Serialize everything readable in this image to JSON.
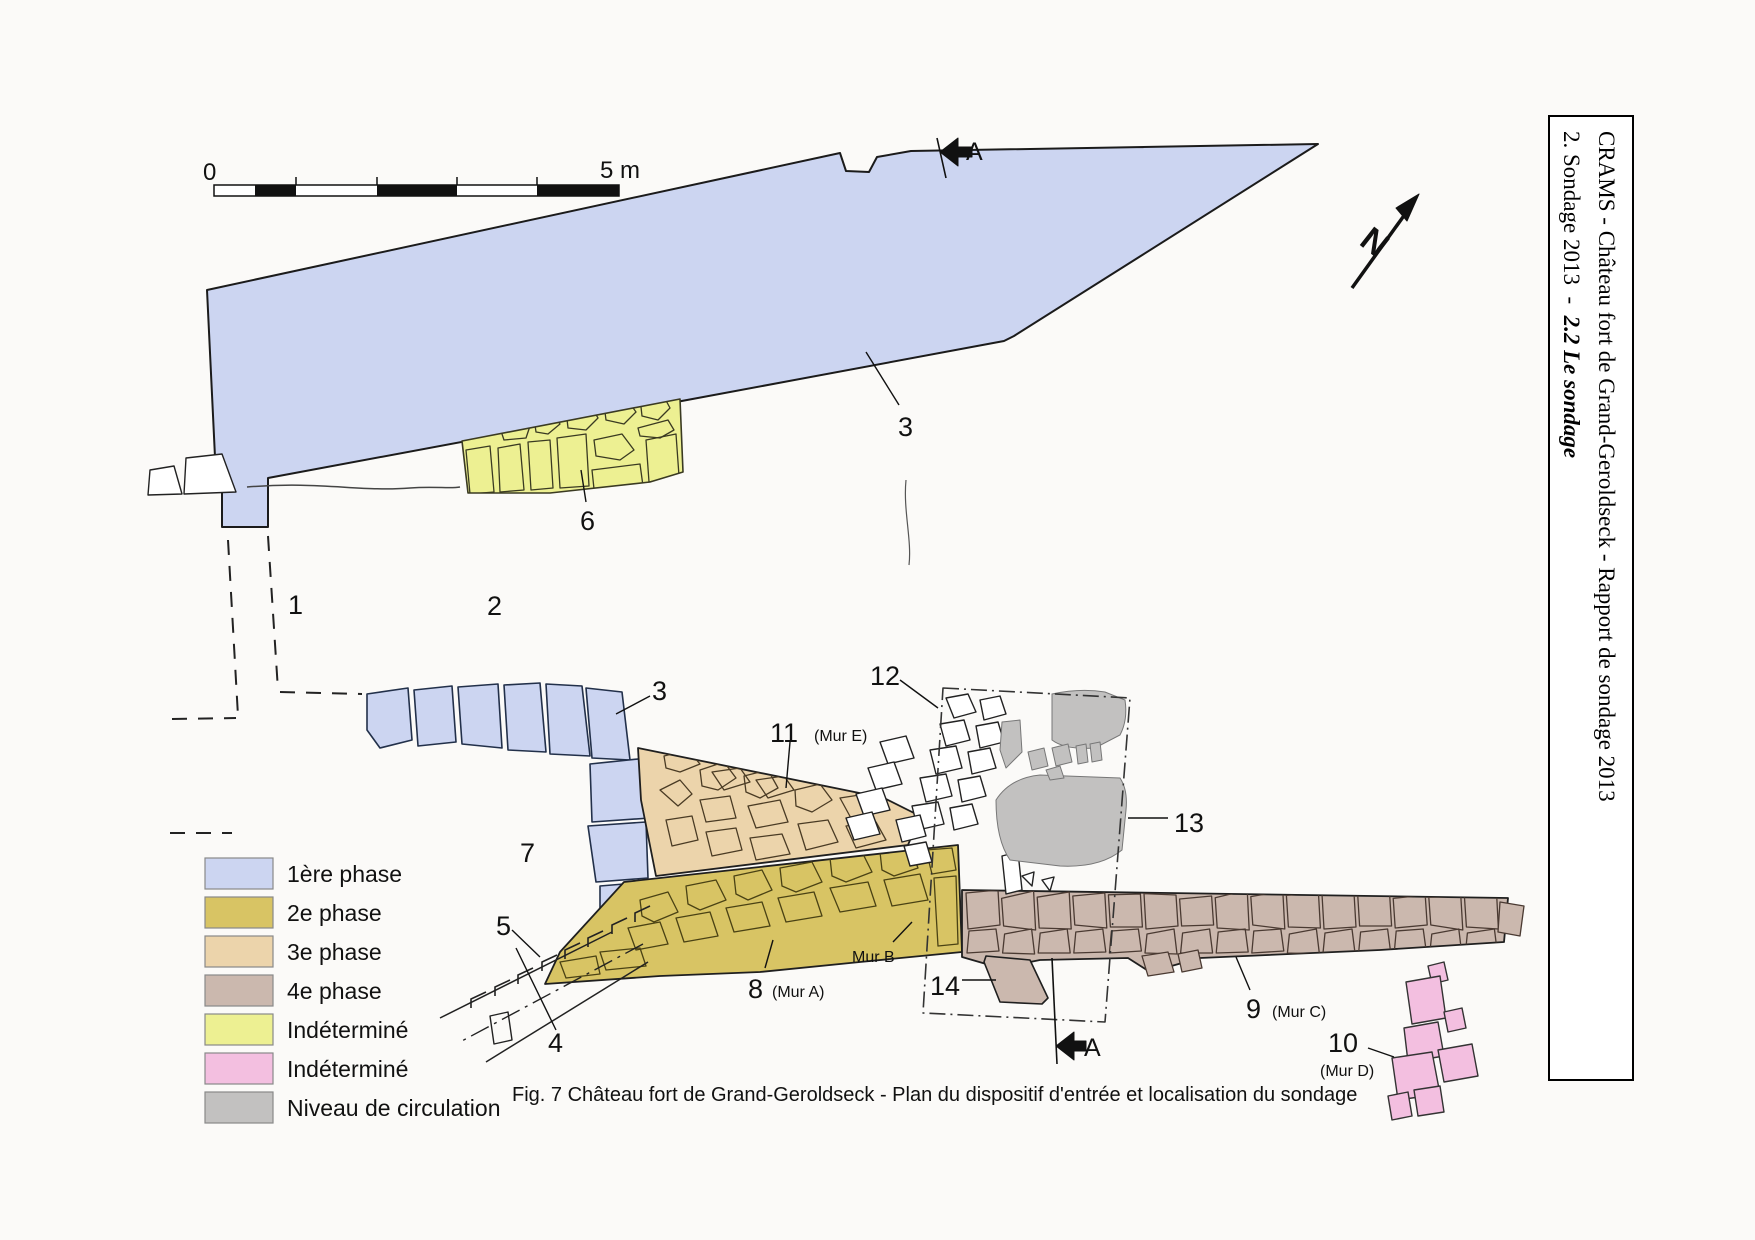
{
  "sidebar": {
    "line1": "CRAMS - Château fort de Grand-Geroldseck - Rapport de sondage 2013",
    "line2_prefix": "2. Sondage 2013  -  ",
    "line2_emphasis": "2.2 Le sondage"
  },
  "caption": "Fig. 7 Château fort de Grand-Geroldseck - Plan du dispositif d'entrée et localisation du sondage",
  "scale_bar": {
    "zero": "0",
    "five": "5 m"
  },
  "north": {
    "letter": "N"
  },
  "section_markers": {
    "top": "A",
    "bottom": "A"
  },
  "legend": {
    "items": [
      {
        "label": "1ère phase",
        "color": "#ccd5f1"
      },
      {
        "label": "2e phase",
        "color": "#d8c464"
      },
      {
        "label": "3e phase",
        "color": "#ecd4ab"
      },
      {
        "label": "4e phase",
        "color": "#cbb8ae"
      },
      {
        "label": "Indéterminé",
        "color": "#edf092"
      },
      {
        "label": "Indéterminé",
        "color": "#f3bfe0"
      },
      {
        "label": "Niveau de circulation",
        "color": "#c2c1c0"
      }
    ]
  },
  "plan": {
    "labels": {
      "n1": "1",
      "n2": "2",
      "n3_upper": "3",
      "n3_lower": "3",
      "n4": "4",
      "n5": "5",
      "n6": "6",
      "n7": "7",
      "n8": "8",
      "n8_sub": "(Mur A)",
      "n9": "9",
      "n9_sub": "(Mur C)",
      "n10": "10",
      "n10_sub": "(Mur D)",
      "n11": "11",
      "n11_sub": "(Mur E)",
      "n12": "12",
      "n13": "13",
      "n14": "14",
      "mur_b": "Mur B"
    }
  }
}
